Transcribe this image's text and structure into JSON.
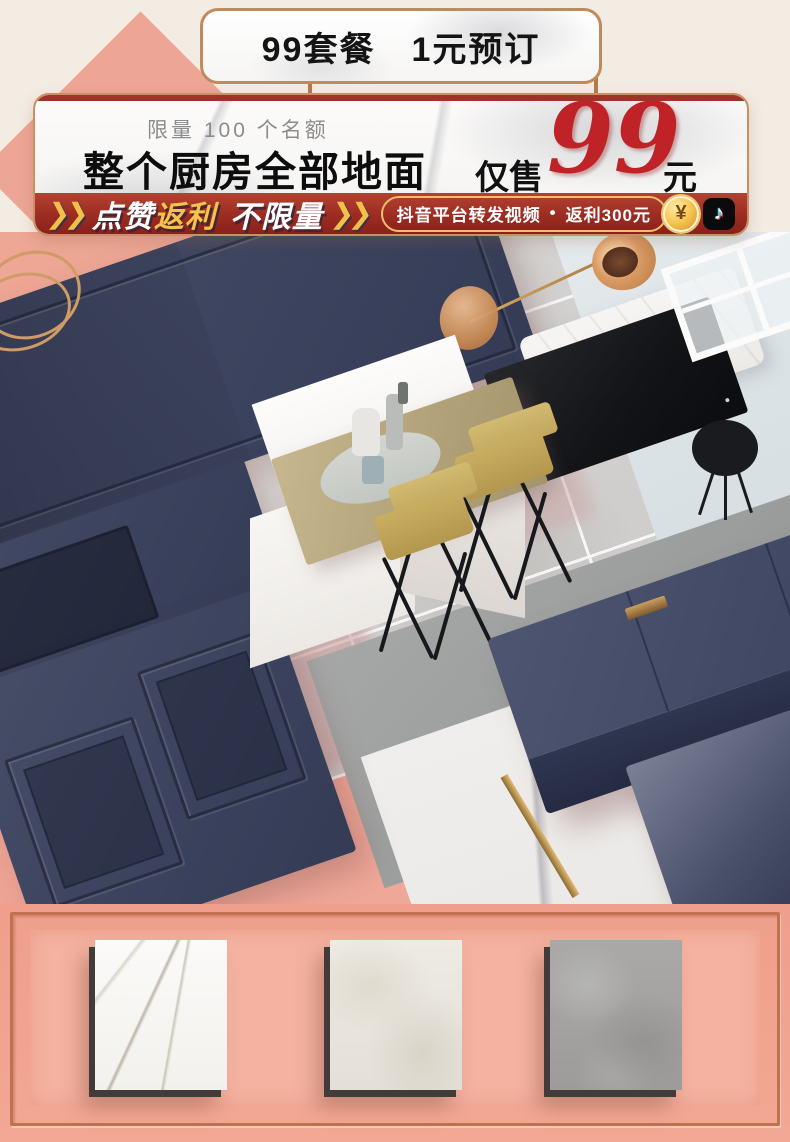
{
  "colors": {
    "cream_bg": "#f3ece3",
    "pink_bg": "#eda192",
    "pink_panel": "#f5b2a0",
    "copper_border": "#bf8a5e",
    "ribbon_red": "#9c2c22",
    "accent_red": "#bf2328",
    "gold_yellow": "#f2c04a",
    "navy": "#3c435e",
    "tile_gray": "#d5d3d1",
    "light_blue": "#dde4e7"
  },
  "top_badge": {
    "label": "99套餐　1元预订"
  },
  "banner": {
    "limit_note": "限量 100 个名额",
    "headline": "整个厨房全部地面",
    "price_prefix": "仅售",
    "price_value": "99",
    "price_unit": "元"
  },
  "ribbon": {
    "chevrons": "❯❯",
    "slogan_like": "点赞",
    "slogan_rebate": "返利",
    "slogan_unlimited": "不限量",
    "pill_text": "抖音平台转发视频",
    "pill_separator": "•",
    "pill_rebate": "返利300元",
    "coin_symbol": "¥",
    "tiktok_glyph": "♪"
  },
  "samples": {
    "tiles": [
      {
        "name": "white-marble-tile"
      },
      {
        "name": "cream-marble-tile"
      },
      {
        "name": "gray-marble-tile"
      }
    ]
  }
}
